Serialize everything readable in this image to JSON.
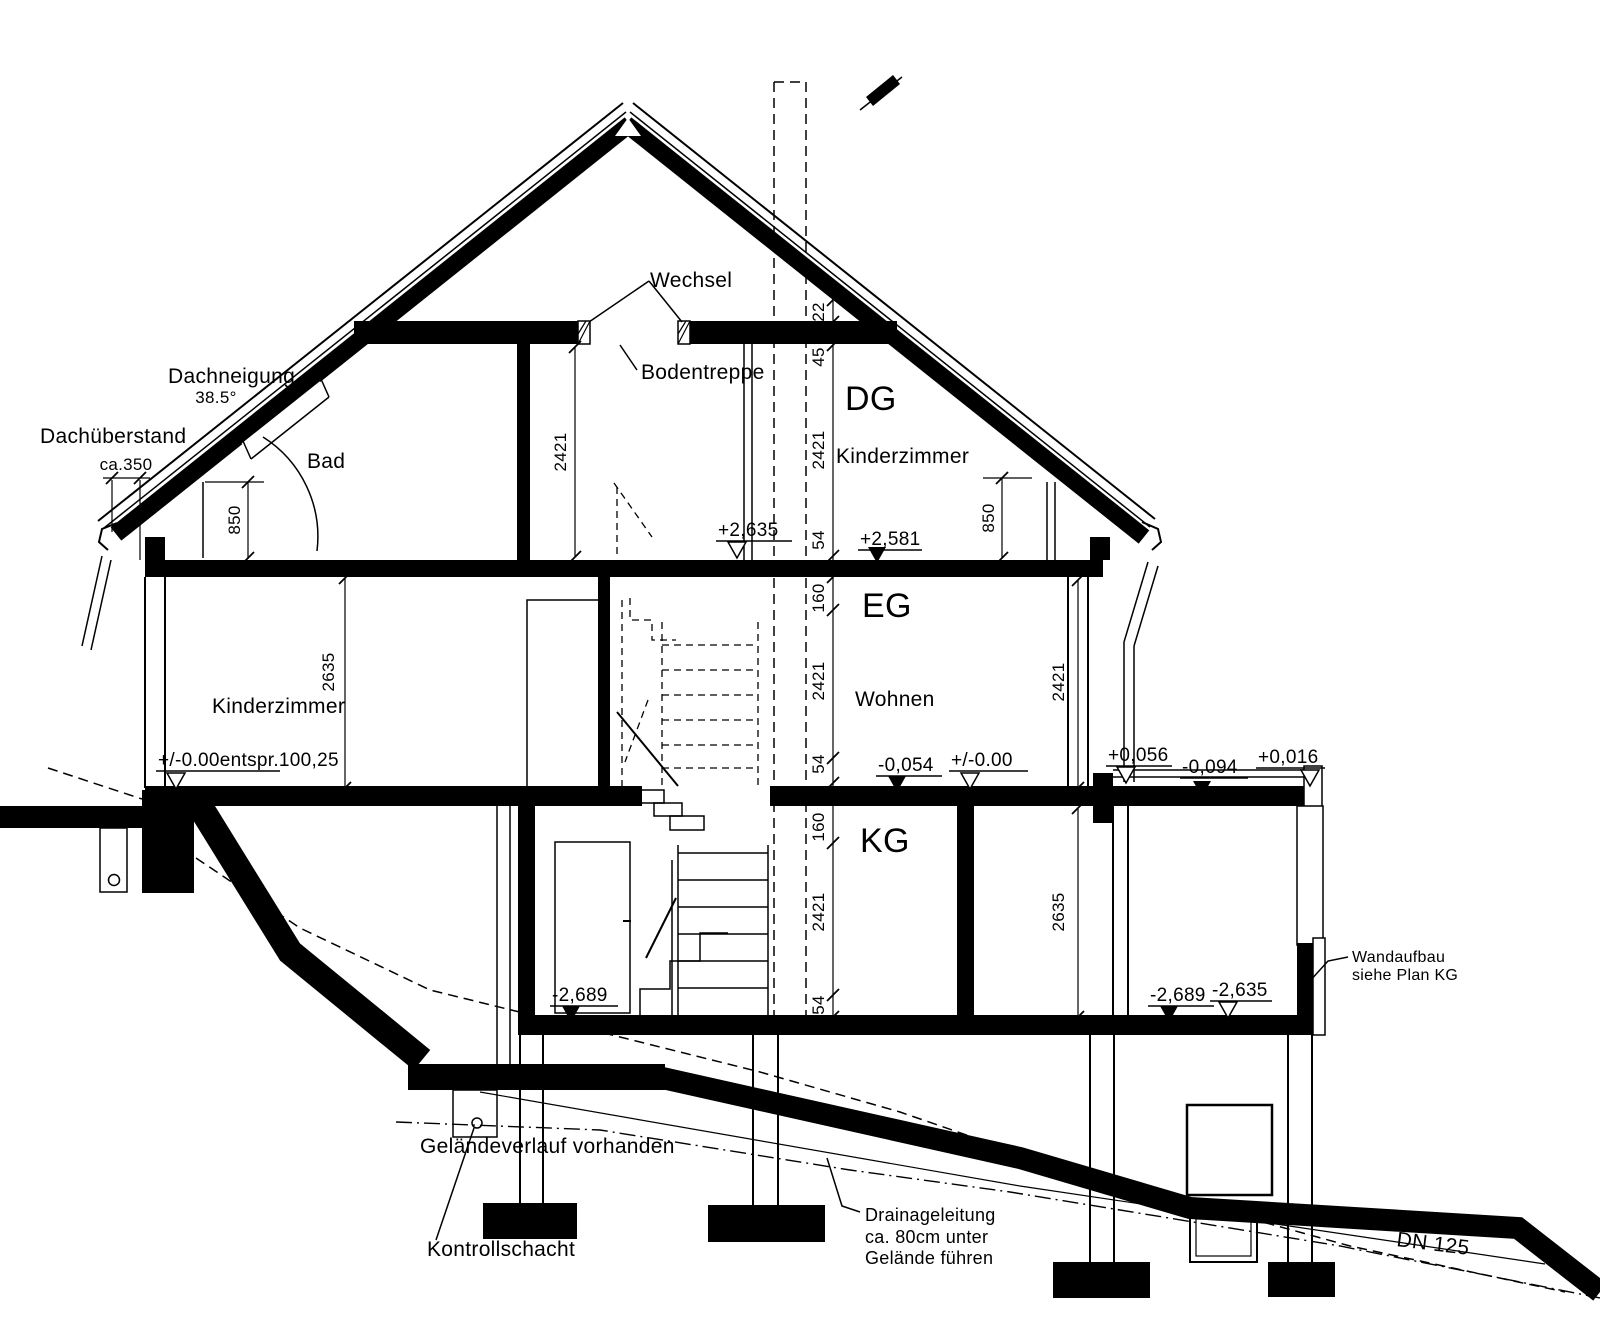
{
  "drawing": {
    "colors": {
      "ink": "#000000",
      "paper": "#ffffff"
    },
    "labels": {
      "wechsel": "Wechsel",
      "bodentreppe": "Bodentreppe",
      "dachneigung": "Dachneigung",
      "dachneigung_value": "38.5°",
      "dachueberstand": "Dachüberstand",
      "dachueberstand_value": "ca.350",
      "bad": "Bad",
      "dg": "DG",
      "dg_room": "Kinderzimmer",
      "eg": "EG",
      "eg_room": "Wohnen",
      "eg_room_left": "Kinderzimmer",
      "kg": "KG",
      "wandaufbau_line1": "Wandaufbau",
      "wandaufbau_line2": "siehe Plan KG",
      "gelaende": "Geländeverlauf vorhanden",
      "kontrollschacht": "Kontrollschacht",
      "drainage_line1": "Drainageleitung",
      "drainage_line2": "ca. 80cm unter",
      "drainage_line3": "Gelände führen",
      "dn": "DN 125"
    },
    "levels": [
      {
        "value": "+2,635",
        "type": "open"
      },
      {
        "value": "+2,581",
        "type": "filled"
      },
      {
        "value": "+/-0.00entspr.100,25",
        "type": "open"
      },
      {
        "value": "-0,054",
        "type": "filled"
      },
      {
        "value": "+/-0.00",
        "type": "open"
      },
      {
        "value": "+0,056",
        "type": "open"
      },
      {
        "value": "-0,094",
        "type": "filled"
      },
      {
        "value": "+0,016",
        "type": "open"
      },
      {
        "value": "-2,689",
        "type": "filled"
      },
      {
        "value": "-2,689",
        "type": "filled"
      },
      {
        "value": "-2,635",
        "type": "open"
      }
    ],
    "dims": {
      "chain": [
        "22",
        "45",
        "2421",
        "54",
        "160",
        "2421",
        "54",
        "160",
        "2421",
        "54"
      ],
      "left_850": "850",
      "right_850": "850",
      "dg_2421": "2421",
      "eg_left_2635": "2635",
      "eg_right_2421": "2421",
      "kg_right_2635": "2635"
    }
  }
}
